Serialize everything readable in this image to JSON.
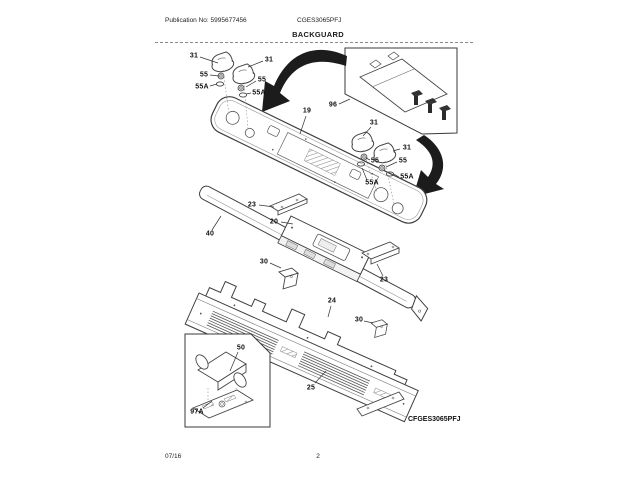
{
  "header": {
    "publication": "Publication No: 5995677456",
    "model": "CGES3065PFJ",
    "section": "BACKGUARD"
  },
  "footer": {
    "date": "07/16",
    "page": "2"
  },
  "diagram": {
    "model_label": "CFGES3065PFJ",
    "callouts": [
      {
        "label": "31"
      },
      {
        "label": "31"
      },
      {
        "label": "55"
      },
      {
        "label": "55A"
      },
      {
        "label": "55"
      },
      {
        "label": "55A"
      },
      {
        "label": "19"
      },
      {
        "label": "96"
      },
      {
        "label": "31"
      },
      {
        "label": "31"
      },
      {
        "label": "55"
      },
      {
        "label": "55"
      },
      {
        "label": "55A"
      },
      {
        "label": "55A"
      },
      {
        "label": "23"
      },
      {
        "label": "20"
      },
      {
        "label": "40"
      },
      {
        "label": "30"
      },
      {
        "label": "23"
      },
      {
        "label": "24"
      },
      {
        "label": "30"
      },
      {
        "label": "25"
      },
      {
        "label": "50"
      },
      {
        "label": "97A"
      }
    ],
    "colors": {
      "line": "#444444",
      "arrow": "#1c1c1c",
      "text": "#111111"
    }
  }
}
